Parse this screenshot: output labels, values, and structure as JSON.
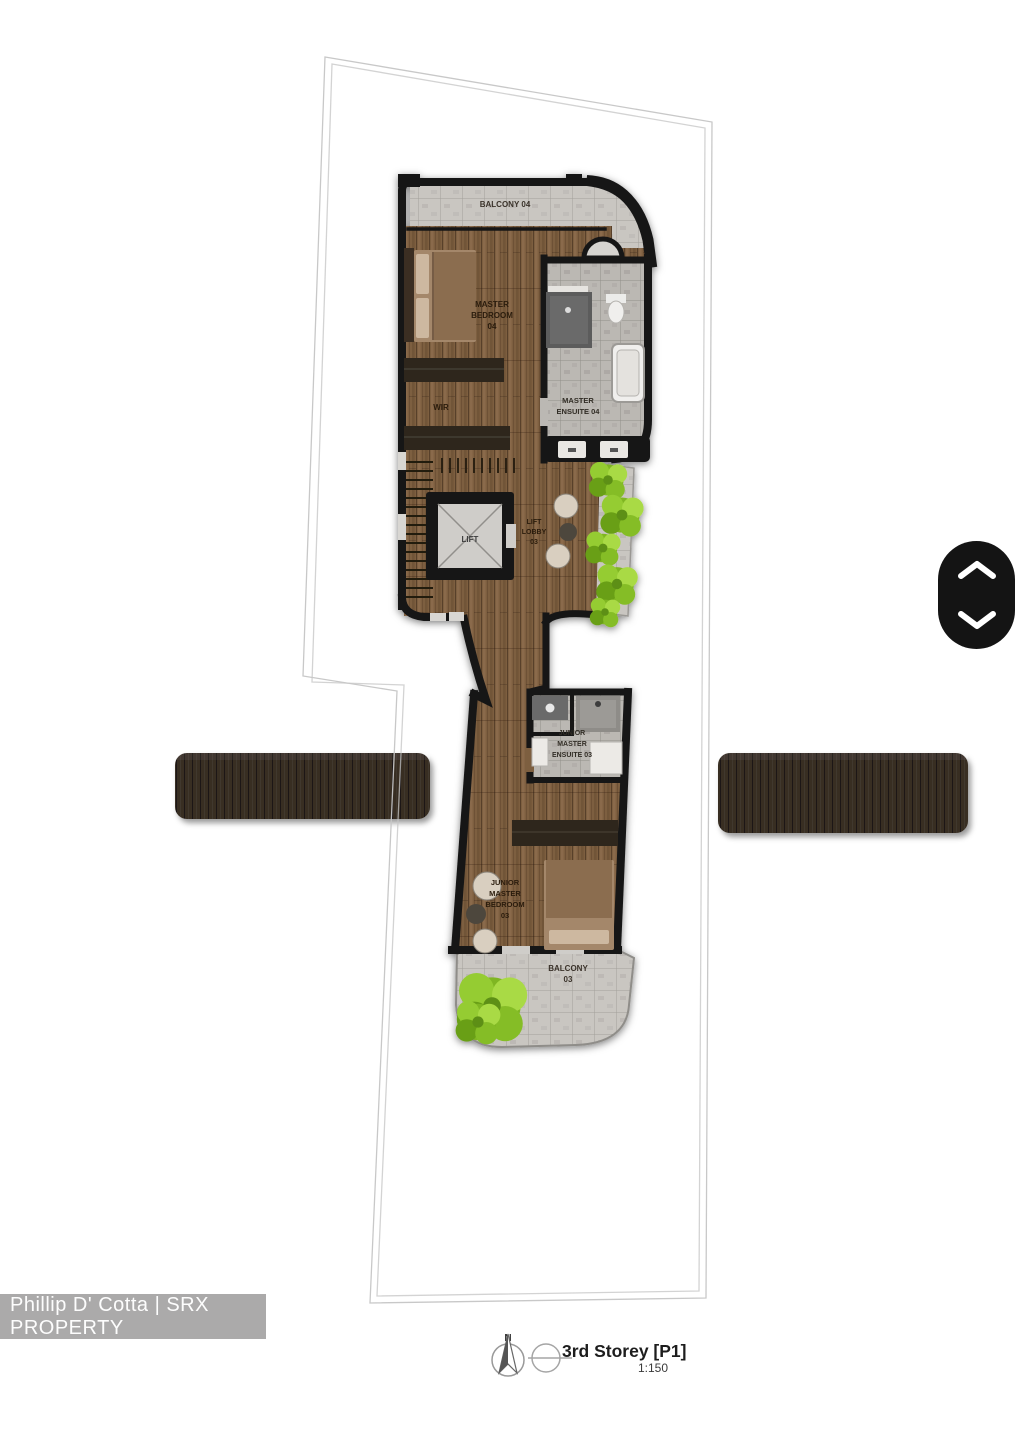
{
  "watermark": {
    "text": "Phillip D' Cotta | SRX PROPERTY"
  },
  "caption": {
    "title": "3rd Storey [P1]",
    "scale": "1:150",
    "north": "N"
  },
  "plan": {
    "rooms": {
      "balcony04": {
        "l1": "BALCONY 04"
      },
      "masterBedroom04": {
        "l1": "MASTER",
        "l2": "BEDROOM",
        "l3": "04"
      },
      "wir": {
        "l1": "WIR"
      },
      "masterEnsuite04": {
        "l1": "MASTER",
        "l2": "ENSUITE 04"
      },
      "lift": {
        "l1": "LIFT"
      },
      "liftLobby03": {
        "l1": "LIFT",
        "l2": "LOBBY",
        "l3": "03"
      },
      "juniorMasterEnsuite03": {
        "l1": "JUNIOR",
        "l2": "MASTER",
        "l3": "ENSUITE 03"
      },
      "juniorMasterBedroom03": {
        "l1": "JUNIOR",
        "l2": "MASTER",
        "l3": "BEDROOM",
        "l4": "03"
      },
      "balcony03": {
        "l1": "BALCONY",
        "l2": "03"
      }
    }
  },
  "colors": {
    "wood_floor": "#7d5e40",
    "stone_floor": "#c9c6c1",
    "wall": "#161616",
    "greenery": "#7fb622",
    "pergola_slab": "#372d24",
    "nav_pill_bg": "#141414",
    "nav_chevron": "#ffffff",
    "watermark_bar": "#abaaaa",
    "watermark_text": "#fdfdfd"
  }
}
